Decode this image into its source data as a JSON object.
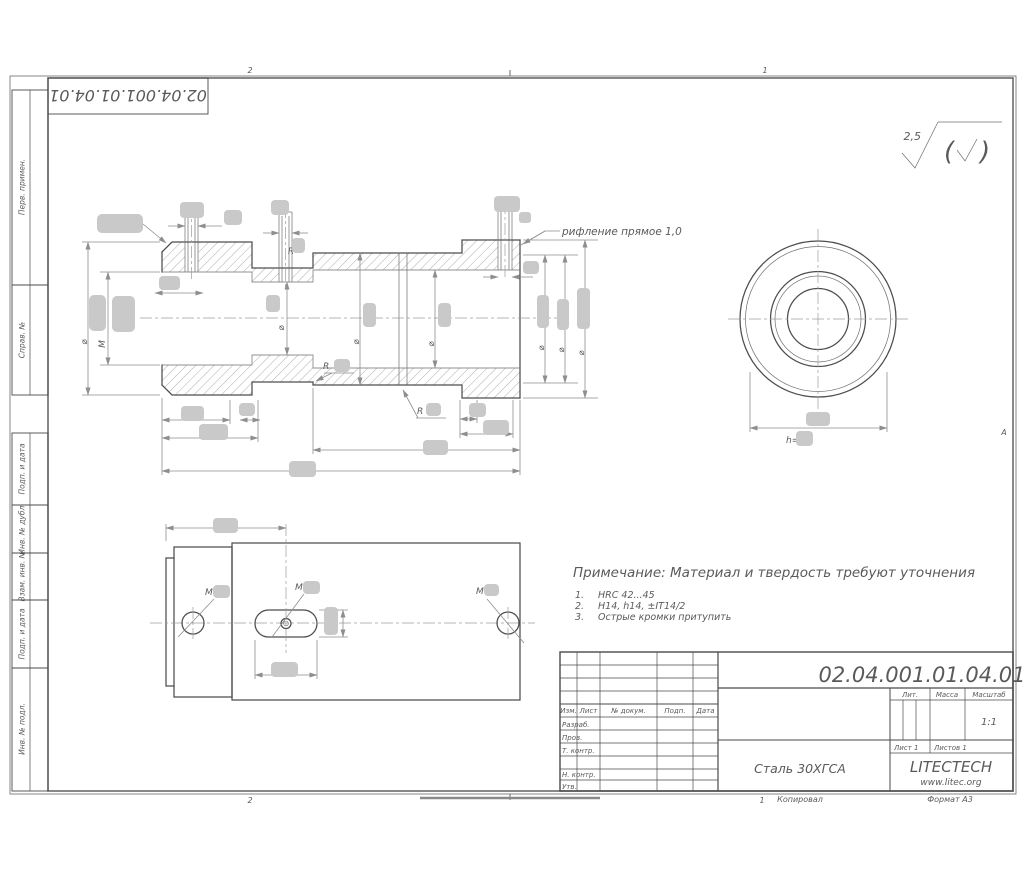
{
  "sheet": {
    "top_stamp_number": "02.04.001.01.04.01",
    "zones": {
      "top_left": "2",
      "top_right": "1",
      "bottom_left": "2",
      "bottom_right": "1",
      "right_row": "А"
    },
    "margin_labels": [
      "Перв. примен.",
      "Справ. №",
      "Подп. и дата",
      "Инв. № дубл.",
      "Взам. инв. №",
      "Подп. и дата",
      "Инв. № подл."
    ],
    "footer": {
      "copied_by": "Копировал",
      "format": "Формат А3"
    }
  },
  "roughness": {
    "value": "2,5",
    "paren_open": "(",
    "paren_close": ")"
  },
  "symbols": {
    "diameter": "⌀",
    "thread": "M",
    "radius": "R",
    "h_prefix": "h="
  },
  "callouts": {
    "knurl": "рифление прямое 1,0"
  },
  "notes": {
    "title": "Примечание: Материал и твердость требуют уточнения",
    "items": [
      {
        "num": "1.",
        "text": "HRC 42...45"
      },
      {
        "num": "2.",
        "text": "H14, h14, ±IT14/2"
      },
      {
        "num": "3.",
        "text": "Острые кромки притупить"
      }
    ]
  },
  "title_block": {
    "doc_number": "02.04.001.01.04.01",
    "header_cols": [
      "Изм.",
      "Лист",
      "№ докум.",
      "Подп.",
      "Дата"
    ],
    "approval_rows": [
      "Разраб.",
      "Пров.",
      "Т. контр.",
      "Н. контр.",
      "Утв."
    ],
    "lit_label": "Лит.",
    "mass_label": "Масса",
    "scale_label": "Масштаб",
    "scale_value": "1:1",
    "sheet_info": "Лист 1",
    "sheets_info": "Листов 1",
    "material": "Сталь 30ХГСА",
    "company": "LITECTECH",
    "website": "www.litec.org"
  },
  "colors": {
    "redaction": "#c9c9c9",
    "outline": "#4d4d4d",
    "dim": "#8e8e8e",
    "frame": "#555555"
  }
}
